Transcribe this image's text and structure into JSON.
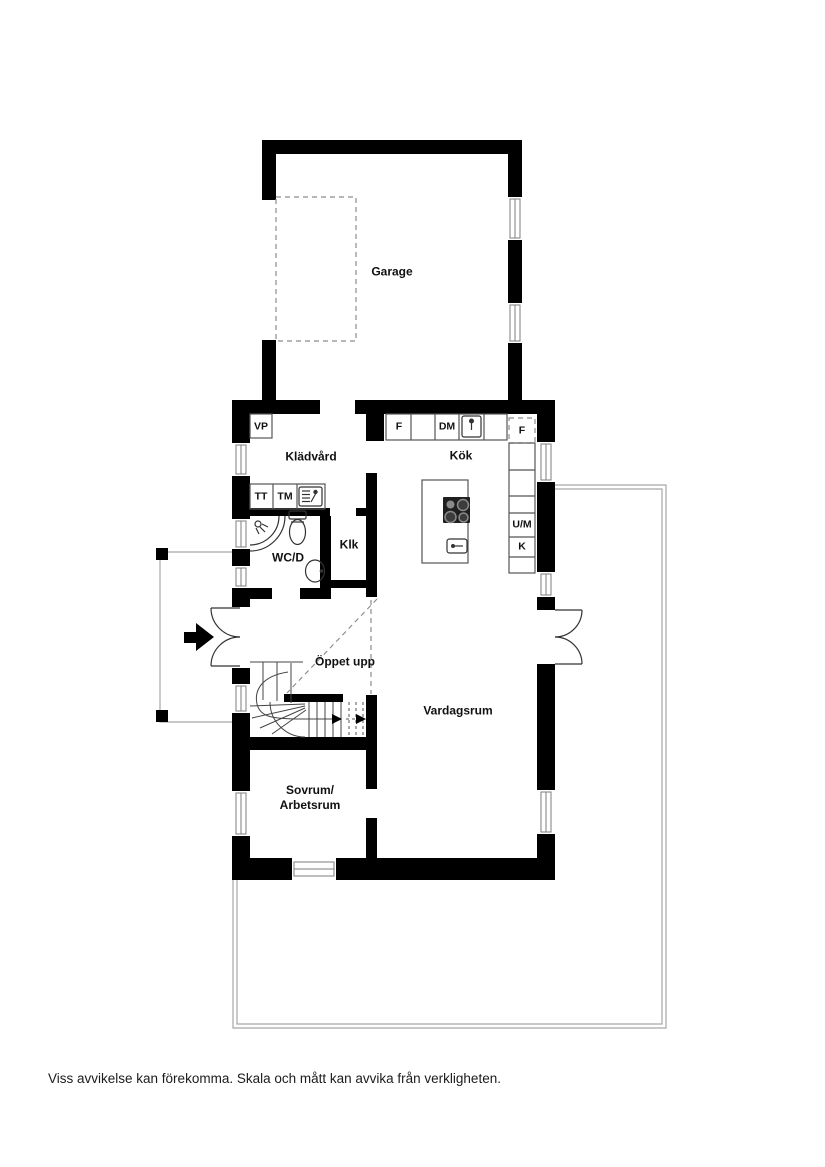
{
  "plan": {
    "rooms": {
      "garage": "Garage",
      "kladvard": "Klädvård",
      "kok": "Kök",
      "wcd": "WC/D",
      "klk": "Klk",
      "oppet_upp": "Öppet upp",
      "vardagsrum": "Vardagsrum",
      "sovrum_arbetsrum": "Sovrum/\nArbetsrum"
    },
    "fixture_labels": {
      "vp": "VP",
      "tt": "TT",
      "tm": "TM",
      "f": "F",
      "dm": "DM",
      "f_dashed": "F",
      "um": "U/M",
      "k": "K"
    },
    "icons": [
      "cooktop-icon",
      "kitchen-sink-icon",
      "laundry-sink-icon",
      "island-sink-icon",
      "shower-icon",
      "toilet-icon",
      "washbasin-icon",
      "entry-arrow-icon",
      "window",
      "double-door"
    ],
    "colors": {
      "wall": "#000000",
      "thin_line": "#a6a6a6",
      "dashed_line": "#8c8c8c",
      "background": "#ffffff"
    }
  },
  "footer": {
    "disclaimer": "Viss avvikelse kan förekomma. Skala och mått kan avvika från verkligheten."
  }
}
